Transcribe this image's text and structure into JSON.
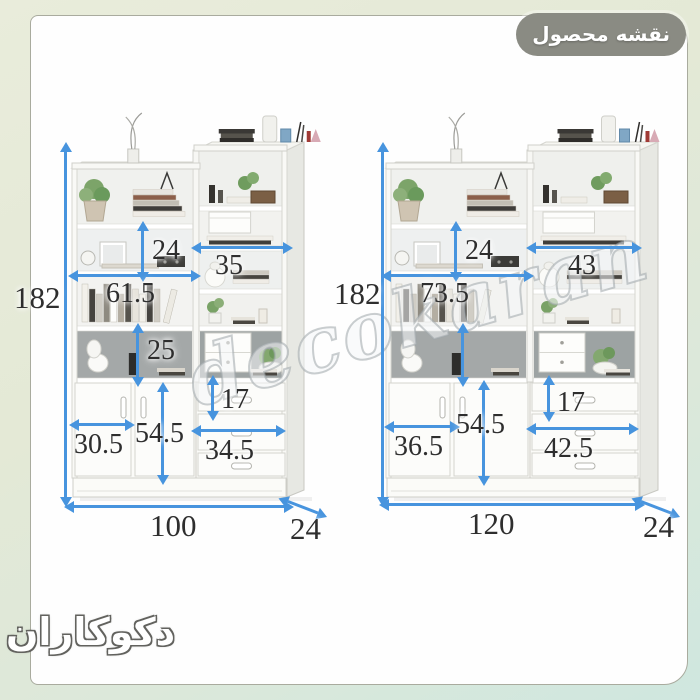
{
  "header": {
    "badge_label": "نقشه محصول"
  },
  "brand": {
    "logo_text": "دکوکاران"
  },
  "watermark_text": "decokaran",
  "colors": {
    "dimension_arrow": "#4794de",
    "dimension_text": "#2e2e2e",
    "badge_background": "#8a8b83",
    "frame_top": "#e9ecdb",
    "frame_bottom": "#cfe7df"
  },
  "left_unit": {
    "total_height": "182",
    "upper_cell_height": "24",
    "right_shelf_width": "35",
    "left_shelf_width": "61.5",
    "middle_cell_height": "25",
    "top_drawer_height": "17",
    "door_width": "30.5",
    "door_height": "54.5",
    "drawer_width": "34.5",
    "total_width": "100",
    "depth": "24"
  },
  "right_unit": {
    "total_height": "182",
    "upper_cell_height": "24",
    "right_shelf_width": "43",
    "left_shelf_width": "73.5",
    "top_drawer_height": "17",
    "door_width": "36.5",
    "door_height": "54.5",
    "drawer_width": "42.5",
    "total_width": "120",
    "depth": "24"
  }
}
